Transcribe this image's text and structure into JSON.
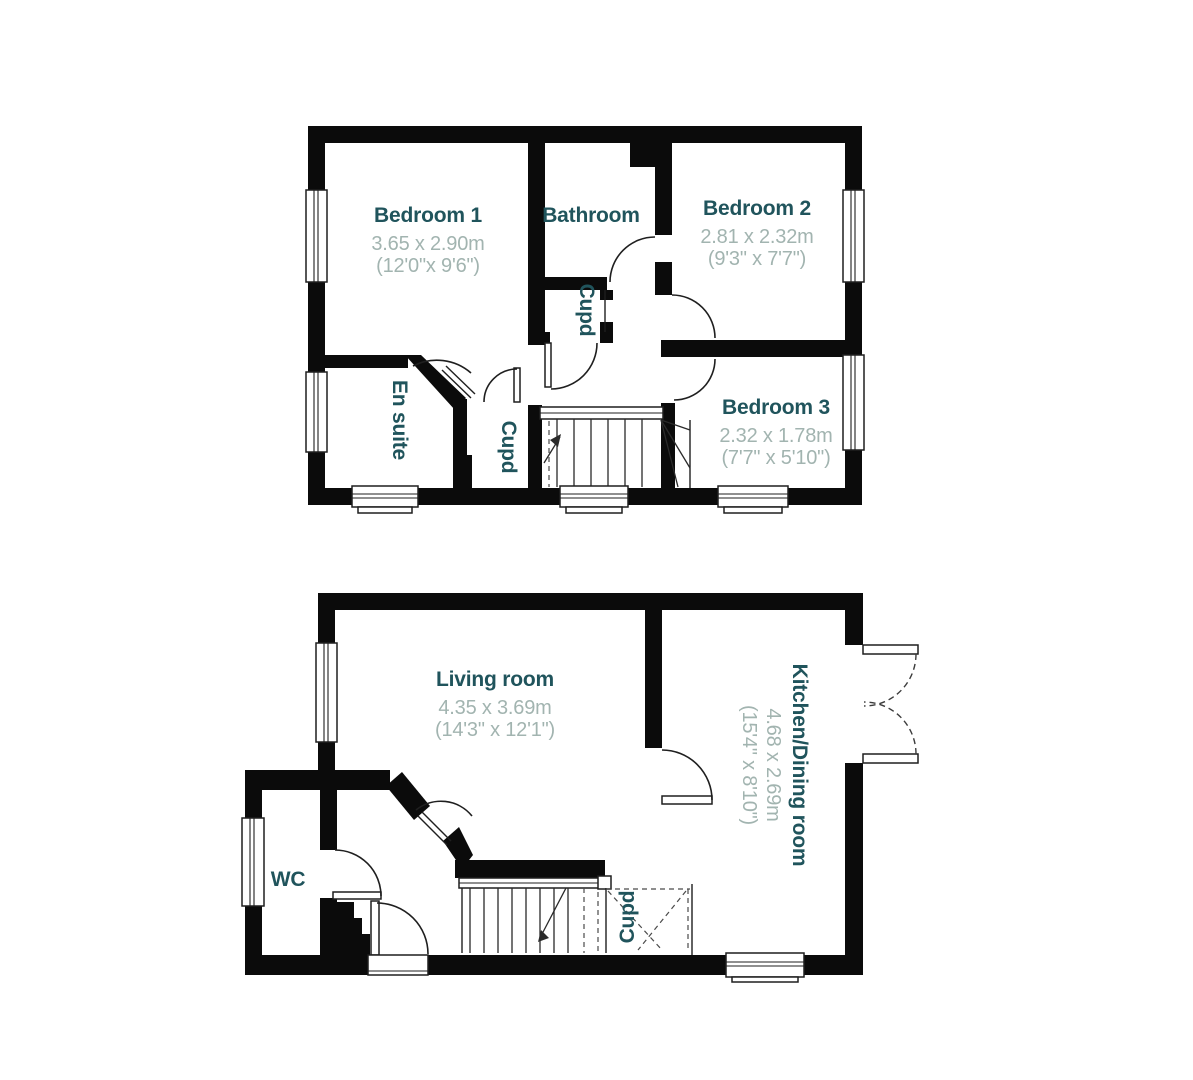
{
  "colors": {
    "wall": "#0b0b0b",
    "line": "#1f1f1f",
    "room_name": "#20545c",
    "dimensions": "#a2b4b0"
  },
  "floors": {
    "first": {
      "rooms": {
        "bedroom1": {
          "name": "Bedroom 1",
          "metric": "3.65 x 2.90m",
          "imperial": "(12'0\"x 9'6\")"
        },
        "bathroom": {
          "name": "Bathroom"
        },
        "bedroom2": {
          "name": "Bedroom 2",
          "metric": "2.81 x 2.32m",
          "imperial": "(9'3\" x 7'7\")"
        },
        "bedroom3": {
          "name": "Bedroom 3",
          "metric": "2.32 x 1.78m",
          "imperial": "(7'7\" x 5'10\")"
        },
        "ensuite": {
          "name": "En suite"
        },
        "cupboard_landing": {
          "name": "Cupd"
        },
        "cupboard_stairs": {
          "name": "Cupd"
        }
      }
    },
    "ground": {
      "rooms": {
        "living": {
          "name": "Living room",
          "metric": "4.35 x 3.69m",
          "imperial": "(14'3\" x 12'1\")"
        },
        "kitchen": {
          "name": "Kitchen/Dining room",
          "metric": "4.68 x 2.69m",
          "imperial": "(15'4\" x 8'10\")"
        },
        "wc": {
          "name": "WC"
        },
        "cupboard_understairs": {
          "name": "Cupd"
        }
      }
    }
  }
}
